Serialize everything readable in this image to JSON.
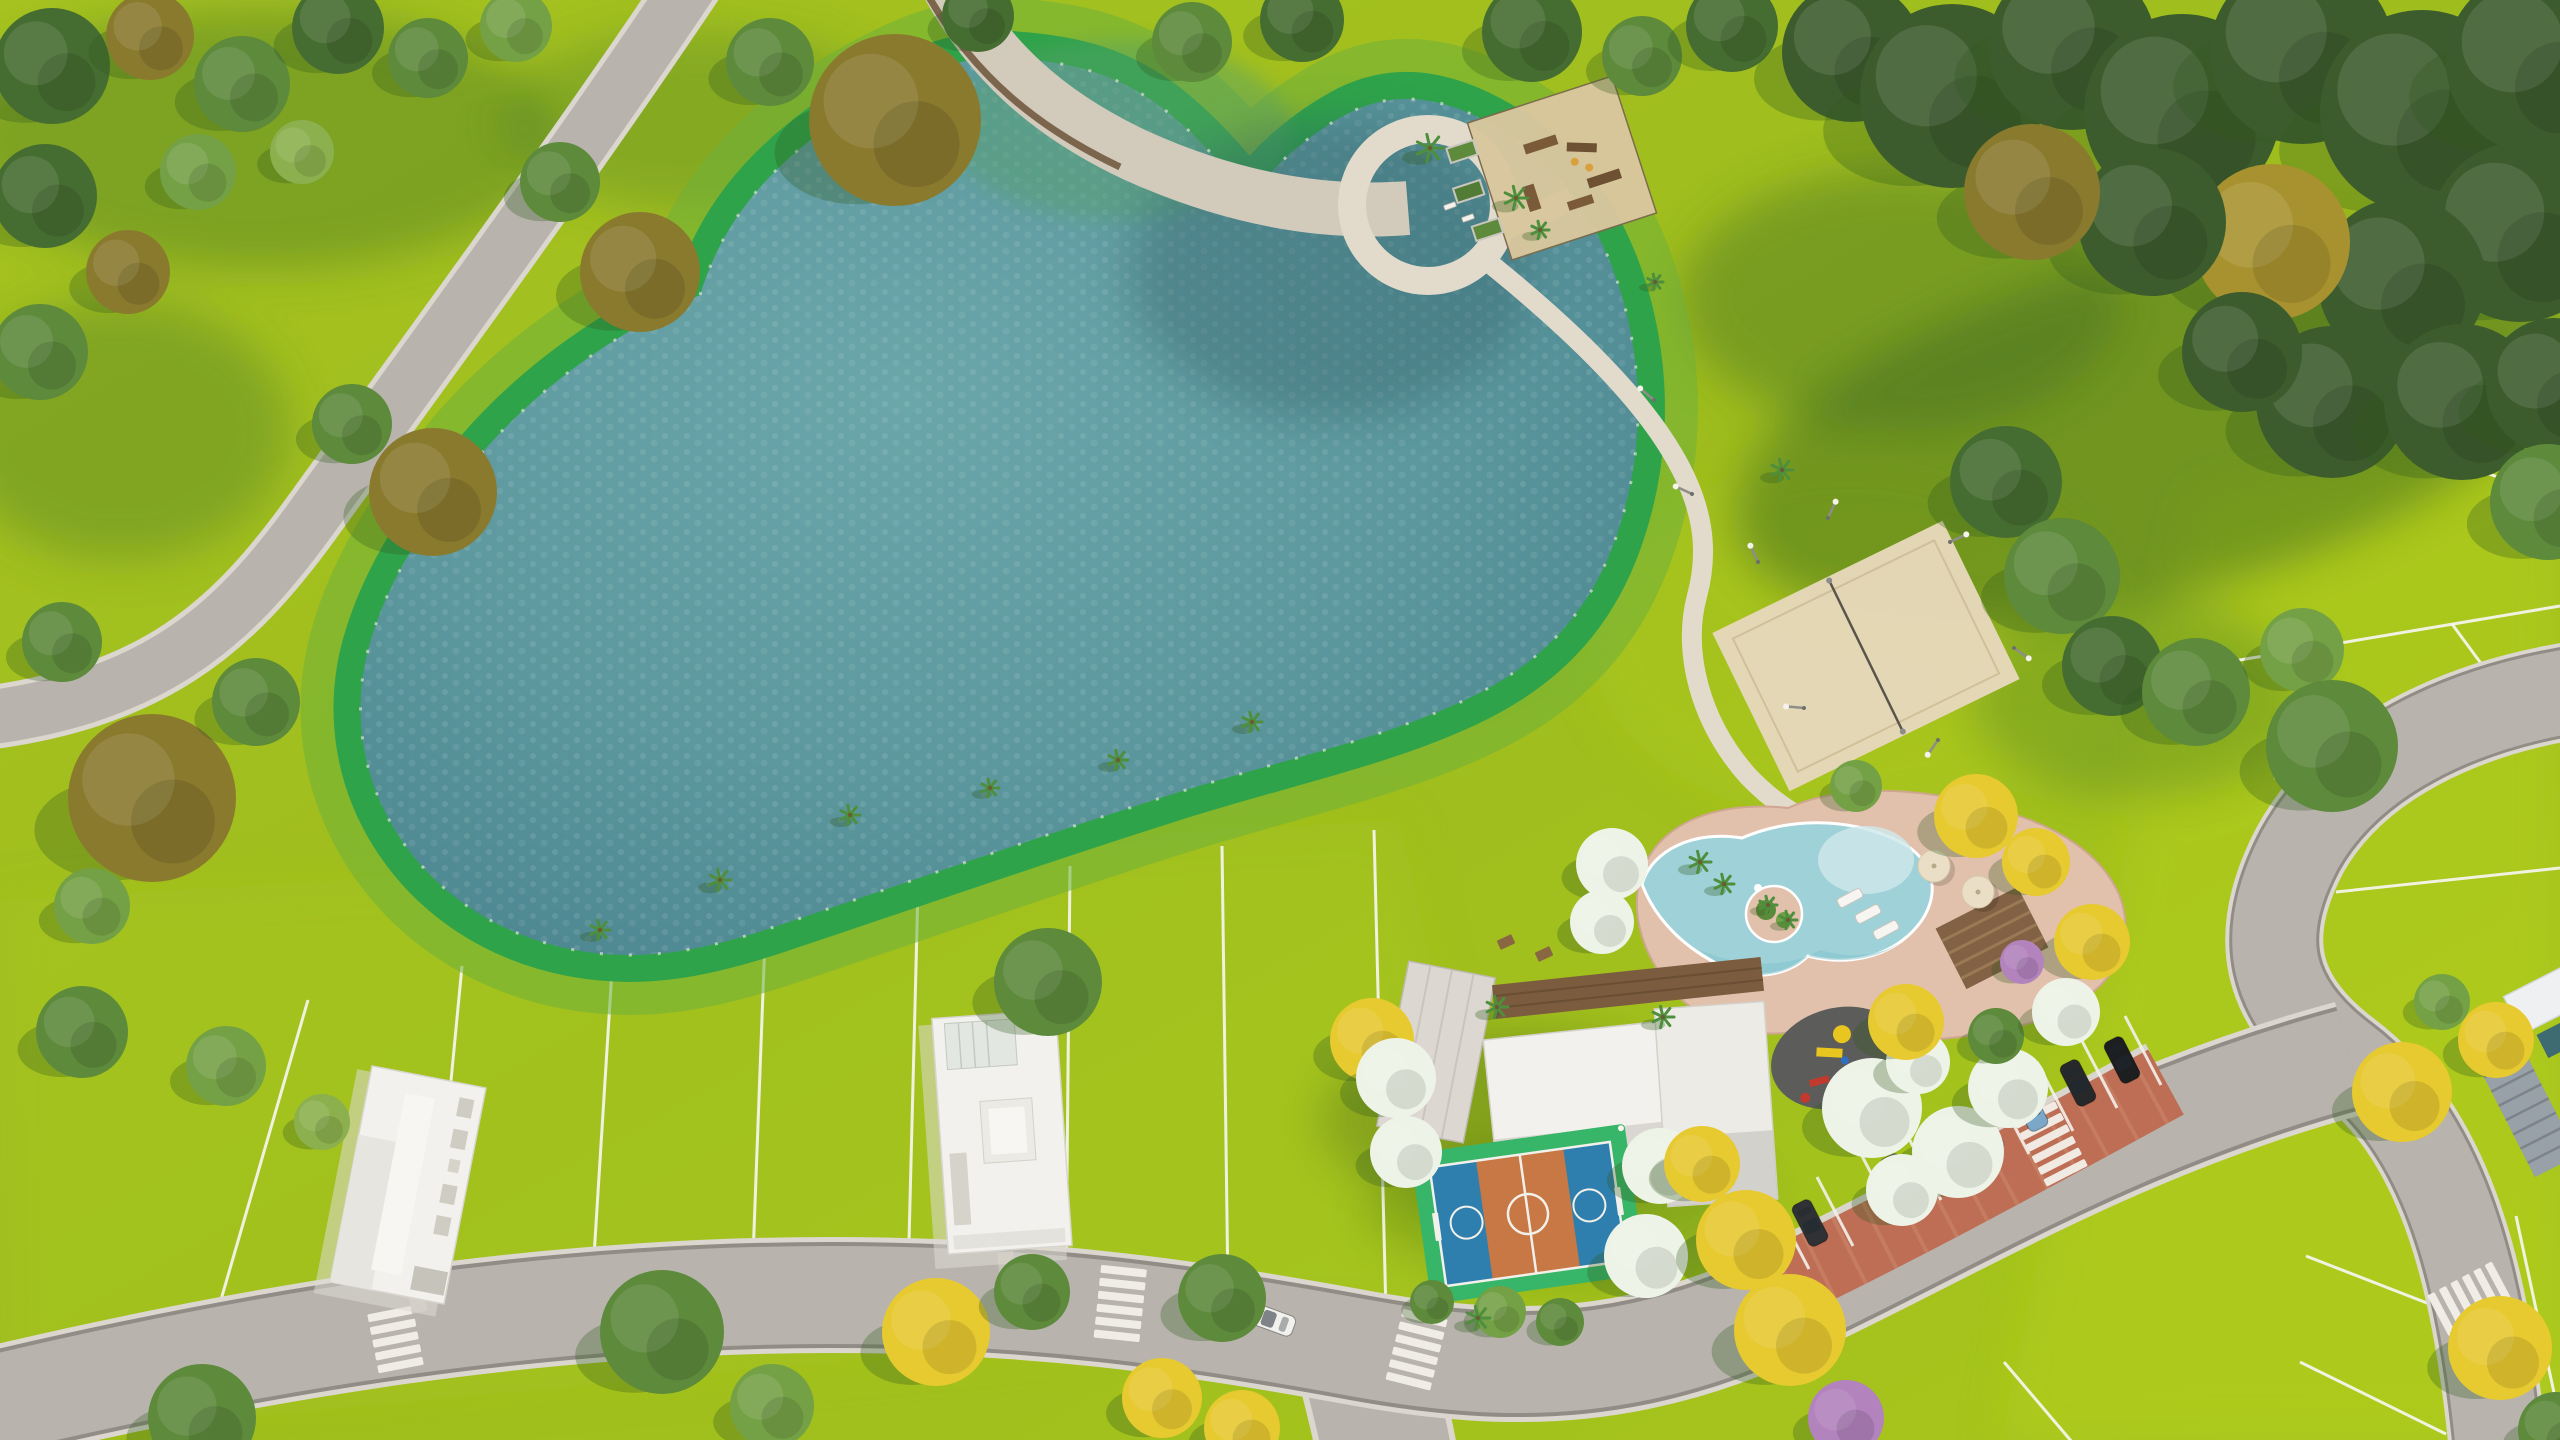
{
  "scene": {
    "type": "aerial-3d-render",
    "setting": "residential-park-masterplan",
    "features": [
      "lake",
      "shore-band",
      "park-lawn",
      "forest",
      "fitness-playground",
      "looped-path",
      "sand-volleyball-court",
      "leisure-pool",
      "pool-deck",
      "pool-island",
      "pergola",
      "clubhouse",
      "wood-deck",
      "multi-sport-court",
      "kids-playground",
      "angled-parking",
      "parked-cars",
      "residential-lots",
      "model-houses",
      "access-roads",
      "crosswalks",
      "walking-paths",
      "entrance-gate",
      "palm-trees",
      "sun-loungers",
      "umbrellas"
    ]
  },
  "palette": {
    "grass": "#a2c01e",
    "grassDeep": "#8fae26",
    "grassShade": "#4e7d26",
    "grassLight": "#b5d017",
    "water": "#5c989e",
    "waterDeep": "#4a838e",
    "waterLight": "#6aa6aa",
    "shoreGreen": "#2fa34a",
    "shoreBand": "#6fb03a",
    "road": "#b8b4ad",
    "roadEdge": "#dbd7cf",
    "roadSeam": "#918d86",
    "path": "#e2dbcc",
    "walk": "#d2cabb",
    "walkEdge": "#6d5339",
    "sand": "#d8c79e",
    "sandVolley": "#e6d8ba",
    "deckPink": "#e2c1ac",
    "poolWater": "#9ed2d8",
    "poolShallow": "#cfe9ec",
    "poolDeep": "#7fc0ca",
    "courtGreen": "#37b568",
    "courtBlue": "#2f7fae",
    "courtOrange": "#c87844",
    "lineWhite": "#f2f0ea",
    "brick": "#bd6e54",
    "brickLight": "#d08a6e",
    "roofWhite": "#f2f1ed",
    "roofGray": "#dcd8d1",
    "roofShade": "#c9c6bf",
    "wood": "#7c5c3e",
    "rubber": "#5c5c5a",
    "gateLouver": "#98a0a8",
    "treeForest": "#3c5c2d",
    "treeDark": "#466d31",
    "treeMid": "#5d8a3b",
    "treeLight": "#74a146",
    "treePale": "#8db04f",
    "treeOlive": "#8a7a2e",
    "treeGold": "#a8922f",
    "treeYellow": "#e7c930",
    "treeWhite": "#eef3e7",
    "treePurple": "#b283bd",
    "palmGreen": "#4e8f3d"
  },
  "trees": [
    [
      52,
      66,
      58,
      "treeDark"
    ],
    [
      150,
      36,
      44,
      "treeOlive"
    ],
    [
      242,
      84,
      48,
      "treeMid"
    ],
    [
      338,
      28,
      46,
      "treeDark"
    ],
    [
      428,
      58,
      40,
      "treeMid"
    ],
    [
      516,
      26,
      36,
      "treeLight"
    ],
    [
      45,
      196,
      52,
      "treeDark"
    ],
    [
      128,
      272,
      42,
      "treeOlive"
    ],
    [
      40,
      352,
      48,
      "treeMid"
    ],
    [
      198,
      172,
      38,
      "treeLight"
    ],
    [
      302,
      152,
      32,
      "treePale"
    ],
    [
      560,
      182,
      40,
      "treeMid"
    ],
    [
      640,
      272,
      60,
      "treeOlive"
    ],
    [
      770,
      62,
      44,
      "treeMid"
    ],
    [
      895,
      120,
      86,
      "treeOlive"
    ],
    [
      978,
      16,
      36,
      "treeDark"
    ],
    [
      433,
      492,
      64,
      "treeOlive"
    ],
    [
      352,
      424,
      40,
      "treeMid"
    ],
    [
      152,
      798,
      84,
      "treeOlive"
    ],
    [
      256,
      702,
      44,
      "treeMid"
    ],
    [
      62,
      642,
      40,
      "treeMid"
    ],
    [
      92,
      906,
      38,
      "treeLight"
    ],
    [
      82,
      1032,
      46,
      "treeMid"
    ],
    [
      226,
      1066,
      40,
      "treeLight"
    ],
    [
      322,
      1122,
      28,
      "treePale"
    ],
    [
      1192,
      42,
      40,
      "treeMid"
    ],
    [
      1302,
      20,
      42,
      "treeDark"
    ],
    [
      1532,
      32,
      50,
      "treeDark"
    ],
    [
      1642,
      56,
      40,
      "treeMid"
    ],
    [
      1732,
      26,
      46,
      "treeDark"
    ],
    [
      1852,
      52,
      70,
      "treeForest"
    ],
    [
      1952,
      96,
      92,
      "treeForest"
    ],
    [
      2072,
      46,
      84,
      "treeForest"
    ],
    [
      2182,
      112,
      98,
      "treeForest"
    ],
    [
      2302,
      52,
      92,
      "treeForest"
    ],
    [
      2422,
      112,
      102,
      "treeForest"
    ],
    [
      2538,
      62,
      92,
      "treeForest"
    ],
    [
      2520,
      232,
      90,
      "treeForest"
    ],
    [
      2402,
      282,
      84,
      "treeForest"
    ],
    [
      2272,
      242,
      78,
      "treeGold"
    ],
    [
      2152,
      222,
      74,
      "treeForest"
    ],
    [
      2032,
      192,
      68,
      "treeOlive"
    ],
    [
      2332,
      402,
      76,
      "treeForest"
    ],
    [
      2462,
      402,
      78,
      "treeForest"
    ],
    [
      2554,
      386,
      68,
      "treeForest"
    ],
    [
      2548,
      502,
      58,
      "treeMid"
    ],
    [
      2242,
      352,
      60,
      "treeForest"
    ],
    [
      2006,
      482,
      56,
      "treeDark"
    ],
    [
      2062,
      576,
      58,
      "treeMid"
    ],
    [
      2112,
      666,
      50,
      "treeDark"
    ],
    [
      2196,
      692,
      54,
      "treeMid"
    ],
    [
      2302,
      650,
      42,
      "treeLight"
    ],
    [
      2332,
      746,
      66,
      "treeMid"
    ],
    [
      1612,
      864,
      36,
      "treeWhite"
    ],
    [
      1602,
      922,
      32,
      "treeWhite"
    ],
    [
      1976,
      816,
      42,
      "treeYellow"
    ],
    [
      2036,
      862,
      34,
      "treeYellow"
    ],
    [
      2092,
      942,
      38,
      "treeYellow"
    ],
    [
      2022,
      962,
      22,
      "treePurple"
    ],
    [
      1856,
      786,
      26,
      "treeLight"
    ],
    [
      1372,
      1040,
      42,
      "treeYellow"
    ],
    [
      1396,
      1078,
      40,
      "treeWhite"
    ],
    [
      1406,
      1152,
      36,
      "treeWhite"
    ],
    [
      1660,
      1166,
      38,
      "treeWhite"
    ],
    [
      1646,
      1256,
      42,
      "treeWhite"
    ],
    [
      1702,
      1164,
      38,
      "treeYellow"
    ],
    [
      1746,
      1240,
      50,
      "treeYellow"
    ],
    [
      1790,
      1330,
      56,
      "treeYellow"
    ],
    [
      1872,
      1108,
      50,
      "treeWhite"
    ],
    [
      1958,
      1152,
      46,
      "treeWhite"
    ],
    [
      2008,
      1088,
      40,
      "treeWhite"
    ],
    [
      1918,
      1062,
      32,
      "treeWhite"
    ],
    [
      1906,
      1022,
      38,
      "treeYellow"
    ],
    [
      1996,
      1036,
      28,
      "treeMid"
    ],
    [
      1902,
      1190,
      36,
      "treeWhite"
    ],
    [
      2066,
      1012,
      34,
      "treeWhite"
    ],
    [
      202,
      1418,
      54,
      "treeMid"
    ],
    [
      662,
      1332,
      62,
      "treeMid"
    ],
    [
      772,
      1406,
      42,
      "treeLight"
    ],
    [
      936,
      1332,
      54,
      "treeYellow"
    ],
    [
      1032,
      1292,
      38,
      "treeMid"
    ],
    [
      1222,
      1298,
      44,
      "treeMid"
    ],
    [
      1162,
      1398,
      40,
      "treeYellow"
    ],
    [
      1242,
      1428,
      38,
      "treeYellow"
    ],
    [
      1846,
      1418,
      38,
      "treePurple"
    ],
    [
      2402,
      1092,
      50,
      "treeYellow"
    ],
    [
      2496,
      1040,
      38,
      "treeYellow"
    ],
    [
      2500,
      1348,
      52,
      "treeYellow"
    ],
    [
      2556,
      1430,
      38,
      "treeMid"
    ],
    [
      2442,
      1002,
      28,
      "treeLight"
    ],
    [
      1048,
      982,
      54,
      "treeMid"
    ],
    [
      1500,
      1312,
      26,
      "treeLight"
    ],
    [
      1560,
      1322,
      24,
      "treeMid"
    ],
    [
      1432,
      1302,
      22,
      "treeMid"
    ]
  ],
  "palms": [
    [
      600,
      930,
      10
    ],
    [
      720,
      880,
      11
    ],
    [
      850,
      815,
      10
    ],
    [
      990,
      788,
      9
    ],
    [
      1118,
      760,
      10
    ],
    [
      1252,
      722,
      10
    ],
    [
      1430,
      148,
      14
    ],
    [
      1516,
      198,
      12
    ],
    [
      1540,
      230,
      9
    ],
    [
      1655,
      282,
      8
    ],
    [
      1782,
      470,
      11
    ],
    [
      1700,
      862,
      11
    ],
    [
      1724,
      884,
      10
    ],
    [
      1768,
      905,
      9
    ],
    [
      1788,
      920,
      9
    ],
    [
      1497,
      1007,
      11
    ],
    [
      1663,
      1017,
      11
    ],
    [
      1478,
      1318,
      12
    ]
  ],
  "cars": [
    {
      "x": 1766,
      "y": 1246,
      "rot": -117,
      "c": "#f4f4f1"
    },
    {
      "x": 1810,
      "y": 1223,
      "rot": -117,
      "c": "#303134"
    },
    {
      "x": 1898,
      "y": 1177,
      "rot": -117,
      "c": "#757a68"
    },
    {
      "x": 1942,
      "y": 1154,
      "rot": -117,
      "c": "#f1f0ec"
    },
    {
      "x": 1986,
      "y": 1131,
      "rot": -117,
      "c": "#d9dadb"
    },
    {
      "x": 2030,
      "y": 1108,
      "rot": -117,
      "c": "#7ba8c9"
    },
    {
      "x": 2078,
      "y": 1083,
      "rot": -117,
      "c": "#27282a"
    },
    {
      "x": 2122,
      "y": 1060,
      "rot": -117,
      "c": "#1d1e20"
    },
    {
      "x": 1272,
      "y": 1320,
      "rot": 20,
      "c": "#f2f1ed"
    }
  ],
  "stalls": [
    [
      1765,
      1292
    ],
    [
      1809,
      1269
    ],
    [
      1853,
      1246
    ],
    [
      1897,
      1223
    ],
    [
      1941,
      1200
    ],
    [
      1985,
      1177
    ],
    [
      2029,
      1154
    ],
    [
      2073,
      1131
    ],
    [
      2117,
      1108
    ],
    [
      2161,
      1085
    ]
  ],
  "lamps": [
    [
      1758,
      562,
      -115
    ],
    [
      1828,
      518,
      -65
    ],
    [
      1950,
      542,
      -25
    ],
    [
      2014,
      648,
      35
    ],
    [
      1938,
      740,
      125
    ],
    [
      1804,
      708,
      -175
    ],
    [
      1654,
      400,
      -140
    ],
    [
      1692,
      494,
      -155
    ]
  ],
  "loungers": [
    [
      1850,
      898,
      -28
    ],
    [
      1868,
      914,
      -28
    ],
    [
      1886,
      930,
      -28
    ]
  ],
  "umbrellas": [
    [
      1934,
      866
    ],
    [
      1978,
      892
    ]
  ],
  "tables": [
    [
      1506,
      942,
      -25
    ],
    [
      1544,
      954,
      -25
    ]
  ],
  "benches": [
    [
      1450,
      206,
      -20
    ],
    [
      1468,
      218,
      -20
    ]
  ],
  "plotLines": [
    [
      308,
      1000,
      218,
      1310
    ],
    [
      462,
      966,
      430,
      1300
    ],
    [
      614,
      938,
      592,
      1288
    ],
    [
      766,
      912,
      752,
      1284
    ],
    [
      918,
      888,
      908,
      1280
    ],
    [
      1070,
      866,
      1066,
      1282
    ],
    [
      1222,
      846,
      1228,
      1292
    ],
    [
      1374,
      830,
      1386,
      1314
    ],
    [
      2228,
      662,
      2560,
      606
    ],
    [
      2274,
      778,
      2560,
      716
    ],
    [
      2336,
      892,
      2560,
      868
    ],
    [
      2452,
      624,
      2508,
      700
    ],
    [
      2486,
      340,
      2560,
      374
    ],
    [
      2424,
      452,
      2560,
      498
    ],
    [
      2306,
      1256,
      2450,
      1312
    ],
    [
      2300,
      1362,
      2446,
      1434
    ],
    [
      2516,
      1216,
      2556,
      1402
    ],
    [
      2004,
      1362,
      2072,
      1442
    ]
  ],
  "crosswalks": [
    [
      1120,
      1306,
      6,
      6
    ],
    [
      1416,
      1352,
      14,
      6
    ],
    [
      2052,
      1146,
      -27,
      6
    ],
    [
      2468,
      1300,
      62,
      6
    ],
    [
      396,
      1342,
      -11,
      5
    ]
  ]
}
